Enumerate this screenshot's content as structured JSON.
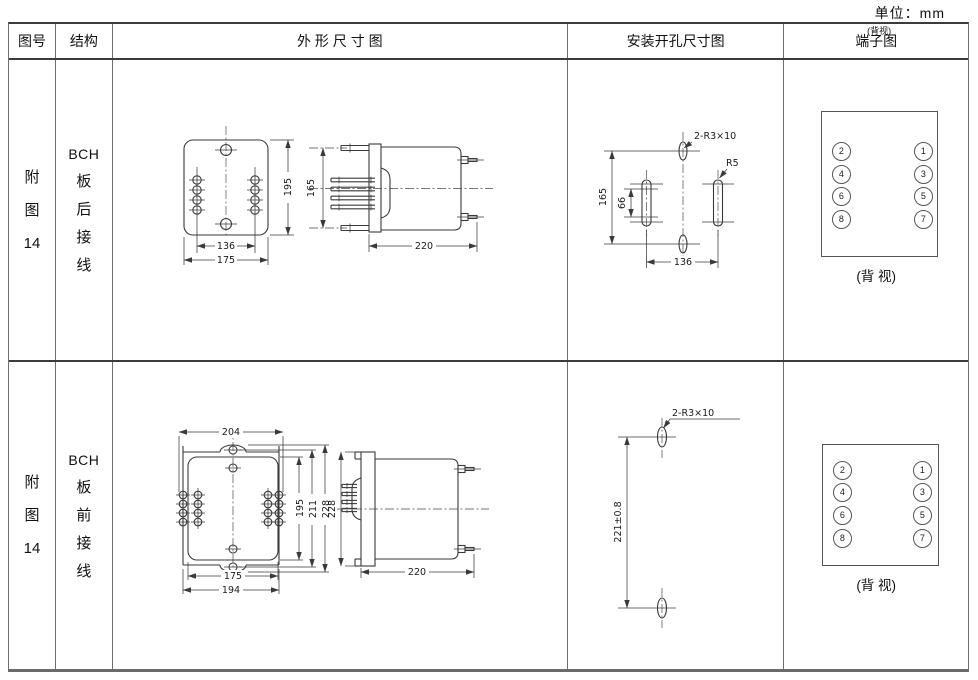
{
  "unit_label": "单位：mm",
  "header": {
    "fig_no": "图号",
    "structure": "结构",
    "outline": "外 形 尺 寸 图",
    "mounting": "安装开孔尺寸图",
    "terminal": "端子图",
    "terminal_note": "(背视)"
  },
  "rows": [
    {
      "fig_no": [
        "附",
        "图",
        "14"
      ],
      "structure": [
        "BCH",
        "板",
        "后",
        "接",
        "线"
      ],
      "outline": {
        "d195": "195",
        "d165": "165",
        "d136": "136",
        "d175": "175",
        "d220": "220"
      },
      "mounting": {
        "slots_label": "2-R3×10",
        "radius_label": "R5",
        "d165": "165",
        "d66": "66",
        "d136": "136"
      },
      "terminal": {
        "n1": "1",
        "n2": "2",
        "n3": "3",
        "n4": "4",
        "n5": "5",
        "n6": "6",
        "n7": "7",
        "n8": "8",
        "caption": "(背 视)"
      }
    },
    {
      "fig_no": [
        "附",
        "图",
        "14"
      ],
      "structure": [
        "BCH",
        "板",
        "前",
        "接",
        "线"
      ],
      "outline": {
        "d204": "204",
        "d195": "195",
        "d211": "211",
        "d228": "228",
        "d175": "175",
        "d194": "194",
        "d220": "220",
        "d228_side": "228"
      },
      "mounting": {
        "slots_label": "2-R3×10",
        "d221": "221±0.8"
      },
      "terminal": {
        "n1": "1",
        "n2": "2",
        "n3": "3",
        "n4": "4",
        "n5": "5",
        "n6": "6",
        "n7": "7",
        "n8": "8",
        "caption": "(背 视)"
      }
    }
  ]
}
